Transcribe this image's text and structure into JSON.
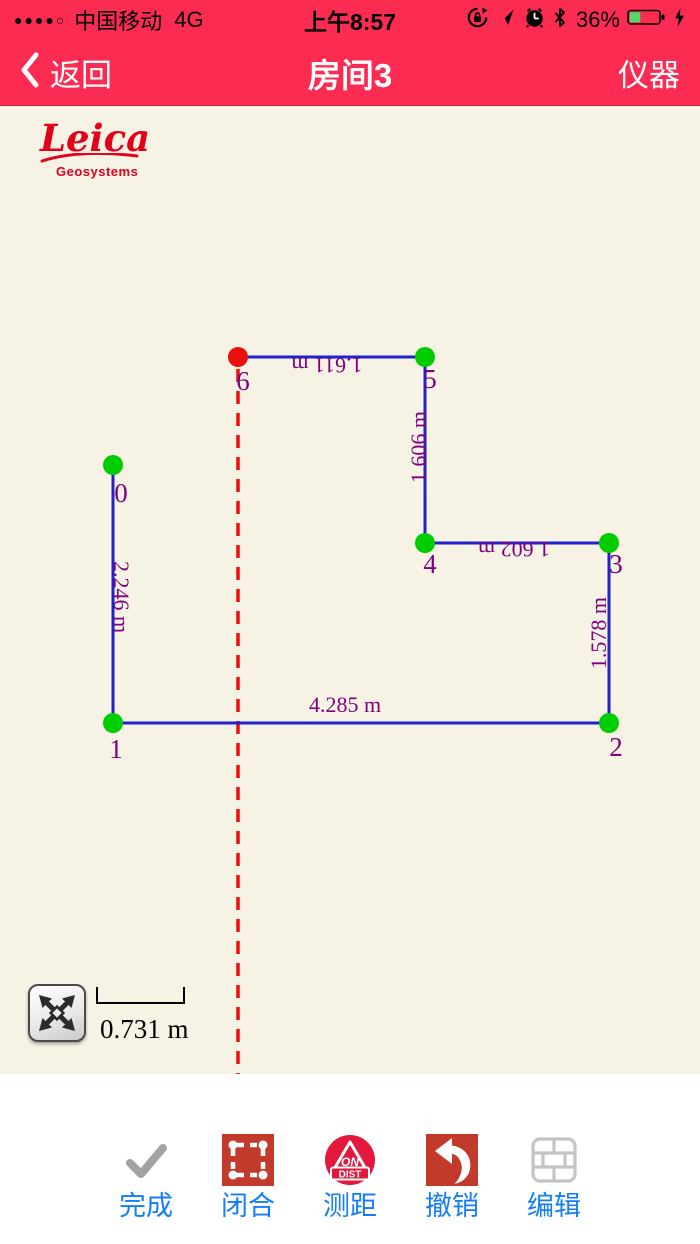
{
  "status_bar": {
    "signal_dots": "●●●●○",
    "carrier": "中国移动",
    "network": "4G",
    "time": "上午8:57",
    "battery_percent": "36%",
    "icons": [
      "orientation-lock",
      "location-arrow",
      "alarm-clock",
      "bluetooth",
      "battery",
      "charging-bolt"
    ]
  },
  "nav_bar": {
    "back_label": "返回",
    "title": "房间3",
    "right_label": "仪器"
  },
  "canvas": {
    "logo_title": "Leica",
    "logo_subtitle": "Geosystems",
    "scale_label": "0.731 m"
  },
  "drawing": {
    "line_color": "#2222cc",
    "line_width": 3,
    "vertex_color": "#00cd00",
    "active_vertex_color": "#ea1010",
    "vertex_radius": 10,
    "label_color": "#800080",
    "edge_label_font_px": 22,
    "vertex_label_font_px": 27,
    "guide_color": "#ea1010",
    "vertices": [
      {
        "id": "0",
        "x": 113,
        "y": 359,
        "label_x": 121,
        "label_y": 396,
        "active": false
      },
      {
        "id": "1",
        "x": 113,
        "y": 617,
        "label_x": 116,
        "label_y": 652,
        "active": false
      },
      {
        "id": "2",
        "x": 609,
        "y": 617,
        "label_x": 616,
        "label_y": 650,
        "active": false
      },
      {
        "id": "3",
        "x": 609,
        "y": 437,
        "label_x": 616,
        "label_y": 467,
        "active": false
      },
      {
        "id": "4",
        "x": 425,
        "y": 437,
        "label_x": 430,
        "label_y": 467,
        "active": false
      },
      {
        "id": "5",
        "x": 425,
        "y": 251,
        "label_x": 430,
        "label_y": 282,
        "active": false
      },
      {
        "id": "6",
        "x": 238,
        "y": 251,
        "label_x": 243,
        "label_y": 284,
        "active": true
      }
    ],
    "edges": [
      {
        "from": "0",
        "to": "1",
        "label": "2.246 m",
        "lx": 114,
        "ly": 491,
        "rot": 90
      },
      {
        "from": "1",
        "to": "2",
        "label": "4.285 m",
        "lx": 345,
        "ly": 606,
        "rot": 0
      },
      {
        "from": "2",
        "to": "3",
        "label": "1.578 m",
        "lx": 606,
        "ly": 527,
        "rot": -90
      },
      {
        "from": "3",
        "to": "4",
        "label": "1.602 m",
        "lx": 514,
        "ly": 436,
        "rot": 180
      },
      {
        "from": "4",
        "to": "5",
        "label": "1.606 m",
        "lx": 426,
        "ly": 341,
        "rot": -90
      },
      {
        "from": "5",
        "to": "6",
        "label": "1.611 m",
        "lx": 327,
        "ly": 252,
        "rot": 180
      }
    ],
    "guide_line": {
      "x": 238,
      "y1": 263,
      "y2": 968,
      "dash": "13 9",
      "width": 3.5
    }
  },
  "toolbar": {
    "items": [
      {
        "label": "完成",
        "icon": "check-icon"
      },
      {
        "label": "闭合",
        "icon": "close-polygon-icon"
      },
      {
        "label": "测距",
        "icon": "measure-distance-icon",
        "icon_text_top": "ON",
        "icon_text_bottom": "DIST"
      },
      {
        "label": "撤销",
        "icon": "undo-icon"
      },
      {
        "label": "编辑",
        "icon": "edit-wall-icon"
      }
    ]
  },
  "colors": {
    "header": "#fb2b52",
    "canvas_bg": "#f6f3e4",
    "tool_red": "#c23a2c",
    "tool_crimson": "#e2183d",
    "label_blue": "#147efa",
    "leica_red": "#e2001a"
  }
}
